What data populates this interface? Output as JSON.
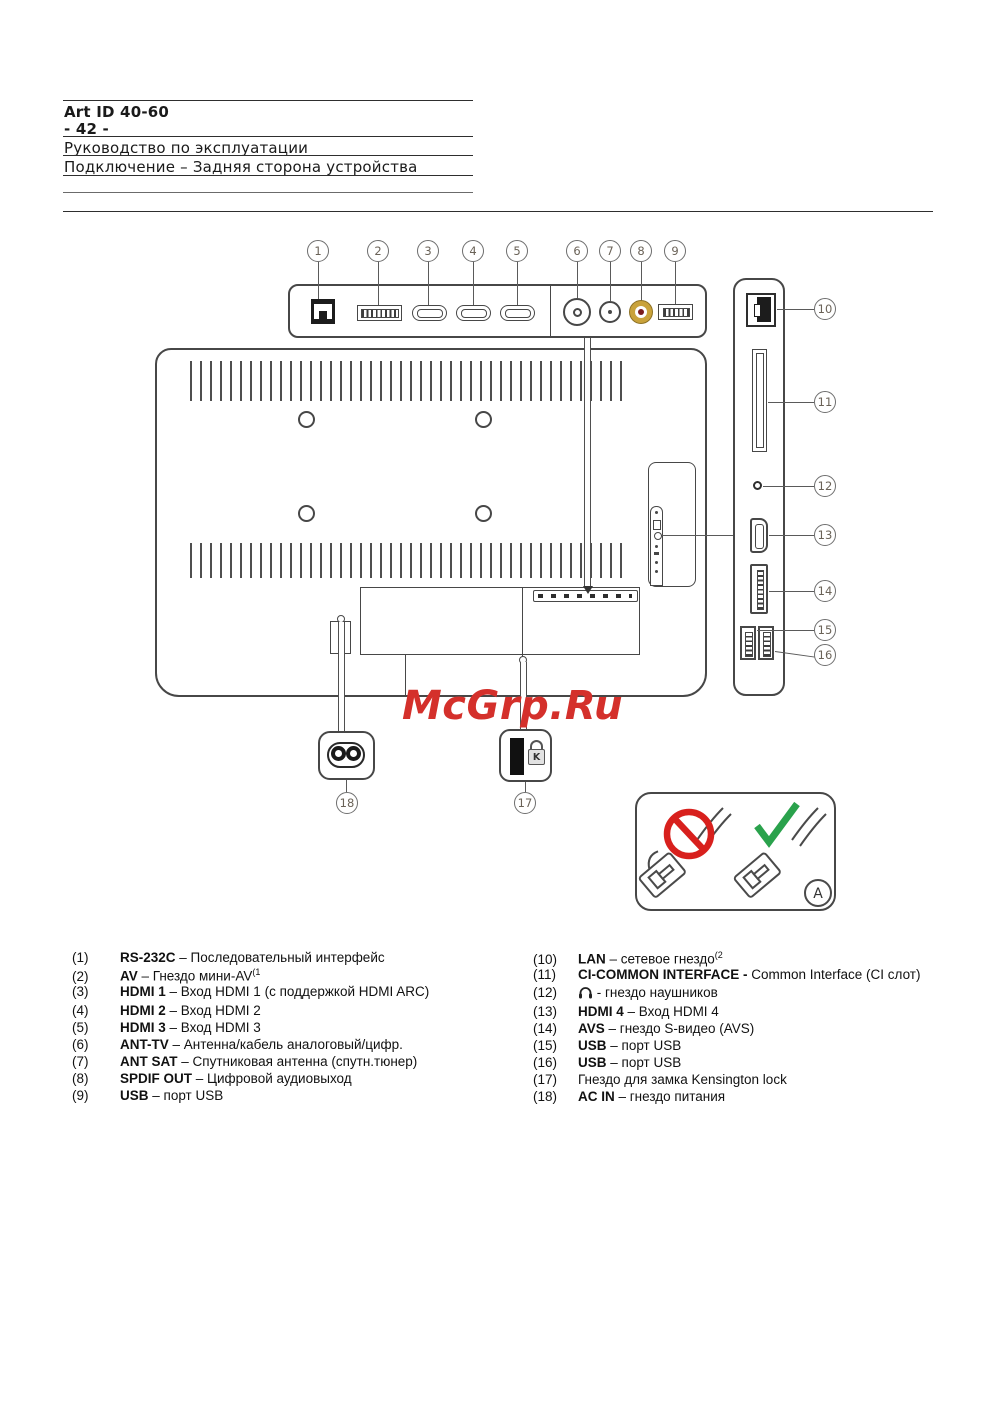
{
  "header": {
    "art_id": "Art ID 40-60",
    "page_no": "- 42 -",
    "line1": "Руководство по эксплуатации",
    "line2": "Подключение – Задняя сторона устройства"
  },
  "watermark": "McGrp.Ru",
  "callouts": [
    "1",
    "2",
    "3",
    "4",
    "5",
    "6",
    "7",
    "8",
    "9",
    "10",
    "11",
    "12",
    "13",
    "14",
    "15",
    "16",
    "17",
    "18"
  ],
  "inset_a_label": "A",
  "kensington_letter": "K",
  "colors": {
    "watermark_red": "#d4302b",
    "prohibition_red": "#d8201d",
    "check_green": "#2aa24c",
    "spdif_gold": "#c9a23a",
    "spdif_center": "#7a1b1b"
  },
  "legend": {
    "left": [
      {
        "num": "(1)",
        "label": "RS-232C",
        "text": " – Последовательный интерфейс"
      },
      {
        "num": "(2)",
        "label": "AV",
        "text": " – Гнездо мини-AV",
        "sup": "(1"
      },
      {
        "num": "(3)",
        "label": "HDMI 1",
        "text": " – Вход HDMI 1 (с поддержкой HDMI ARC)"
      },
      {
        "num": "(4)",
        "label": "HDMI 2",
        "text": " – Вход HDMI 2"
      },
      {
        "num": "(5)",
        "label": "HDMI 3",
        "text": " – Вход HDMI 3"
      },
      {
        "num": "(6)",
        "label": "ANT-TV",
        "text": " – Антенна/кабель аналоговый/цифр."
      },
      {
        "num": "(7)",
        "label": "ANT SAT",
        "text": " – Спутниковая антенна (спутн.тюнер)"
      },
      {
        "num": "(8)",
        "label": "SPDIF OUT",
        "text": " – Цифровой аудиовыход"
      },
      {
        "num": "(9)",
        "label": "USB",
        "text": " – порт USB"
      }
    ],
    "right": [
      {
        "num": "(10)",
        "label": "LAN",
        "text": " – сетевое гнездо",
        "sup": "(2"
      },
      {
        "num": "(11)",
        "label": "CI-COMMON INTERFACE -",
        "text": " Common Interface (CI слот)"
      },
      {
        "num": "(12)",
        "label": "",
        "text": " - гнездо наушников"
      },
      {
        "num": "(13)",
        "label": "HDMI 4",
        "text": " – Вход HDMI 4"
      },
      {
        "num": "(14)",
        "label": "AVS",
        "text": " – гнездо S-видео (AVS)"
      },
      {
        "num": "(15)",
        "label": "USB",
        "text": " – порт USB"
      },
      {
        "num": "(16)",
        "label": "USB",
        "text": " – порт USB"
      },
      {
        "num": "(17)",
        "label": "",
        "text": "Гнездо для замка Kensington lock"
      },
      {
        "num": "(18)",
        "label": "AC IN",
        "text": " – гнездо питания"
      }
    ]
  }
}
